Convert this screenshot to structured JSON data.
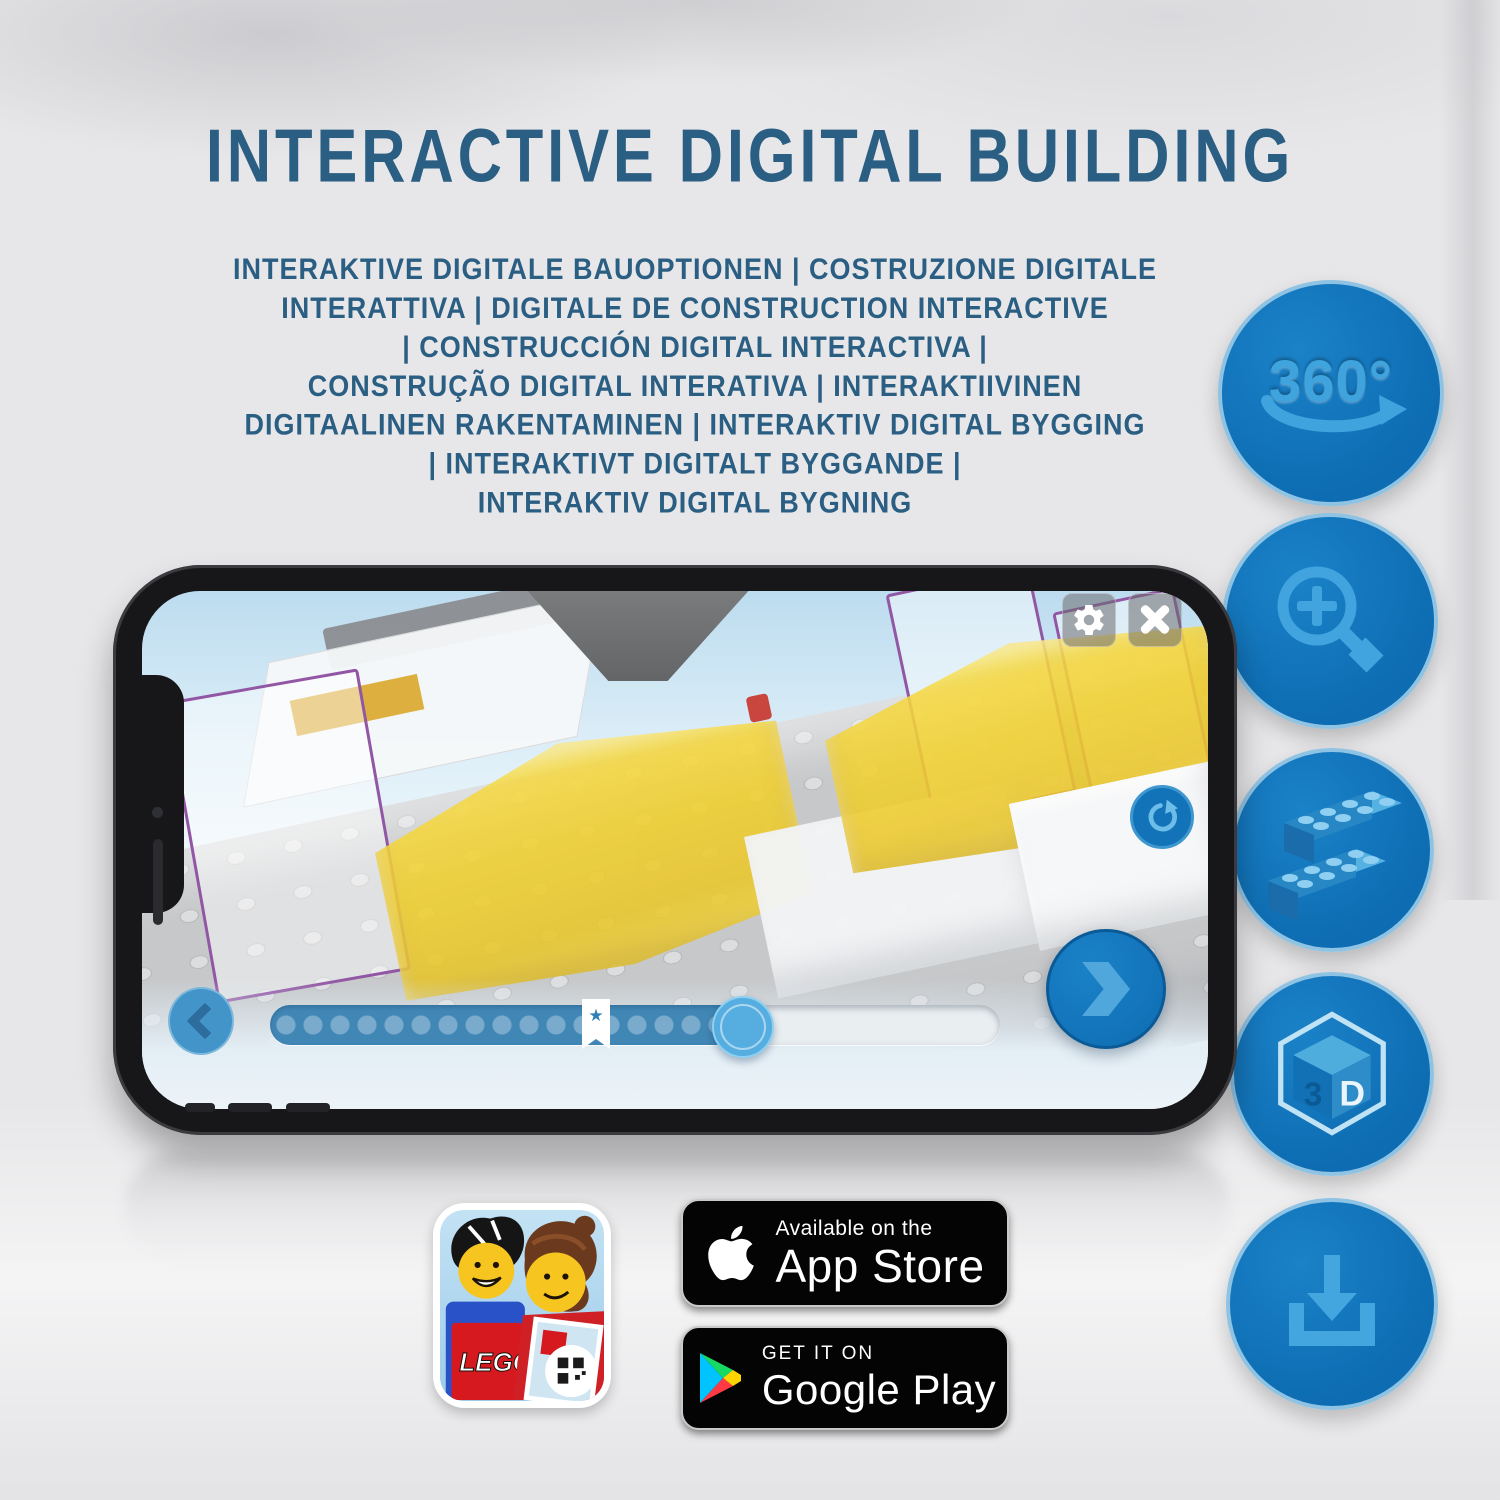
{
  "title": "INTERACTIVE DIGITAL BUILDING",
  "subtitle_lines": [
    "INTERAKTIVE DIGITALE BAUOPTIONEN | COSTRUZIONE DIGITALE",
    "INTERATTIVA | DIGITALE DE CONSTRUCTION INTERACTIVE",
    "| CONSTRUCCIÓN DIGITAL INTERACTIVA |",
    "CONSTRUÇÃO DIGITAL INTERATIVA | INTERAKTIIVINEN",
    "DIGITAALINEN RAKENTAMINEN | INTERAKTIV DIGITAL BYGGING",
    "| INTERAKTIVT DIGITALT BYGGANDE |",
    "INTERAKTIV DIGITAL BYGNING"
  ],
  "feature_icons": [
    {
      "name": "360-rotation",
      "label": "360°"
    },
    {
      "name": "zoom-in"
    },
    {
      "name": "brick-building"
    },
    {
      "name": "3d-view",
      "face_left": "3",
      "face_right": "D"
    },
    {
      "name": "download-offline"
    }
  ],
  "phone_app": {
    "progress_star": "★"
  },
  "app_icon": {
    "logo_text": "LEGO"
  },
  "badges": {
    "app_store": {
      "line1": "Available on the",
      "line2": "App Store"
    },
    "google_play": {
      "line1": "GET IT ON",
      "line2": "Google Play"
    }
  },
  "colors": {
    "heading_blue": "#2a5e82",
    "circle_fill": "#0d6fb6",
    "glyph_blue": "#41a4de",
    "brick_yellow": "#f2d335"
  }
}
